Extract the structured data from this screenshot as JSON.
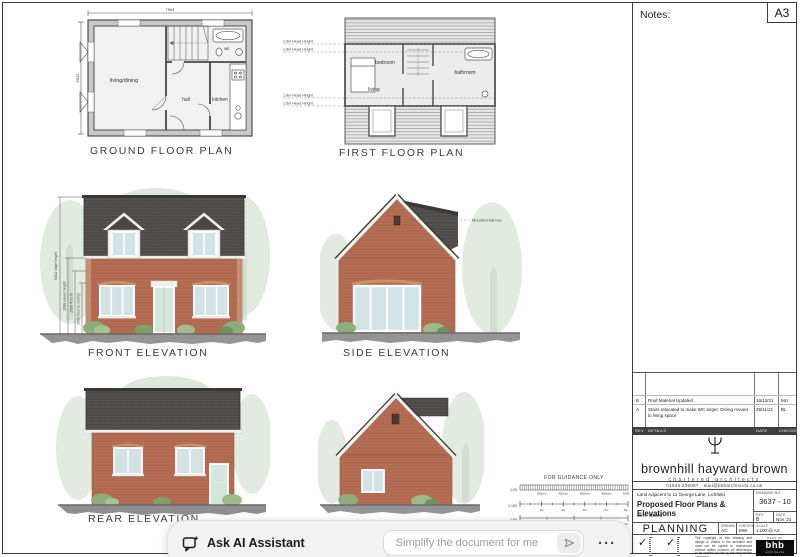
{
  "sheet": {
    "notes_label": "Notes:",
    "size_label": "A3"
  },
  "plans": {
    "ground": {
      "title": "GROUND FLOOR PLAN",
      "dim_width": "7904",
      "dim_height": "5532",
      "rooms": {
        "living": "living/dining",
        "hall": "hall",
        "kitchen": "kitchen",
        "wc": "wc"
      }
    },
    "first": {
      "title": "FIRST FLOOR PLAN",
      "rooms": {
        "bedroom": "bedroom",
        "living": "living",
        "bathroom": "bathroom"
      },
      "head_heights": [
        "1.5m Head Height",
        "1.8m Head Height",
        "1.8m Head Height",
        "1.5m Head Height"
      ]
    }
  },
  "elevations": {
    "front": {
      "title": "FRONT ELEVATION",
      "dims": [
        "6381 ridge height",
        "3088 eaves height",
        "2500 ffl to ffl",
        "2050 floor to ceiling"
      ]
    },
    "side": {
      "title": "SIDE ELEVATION",
      "annotation": "Mounted bat box"
    },
    "rear": {
      "title": "REAR ELEVATION"
    }
  },
  "scale_bar": {
    "title": "FOR GUIDANCE ONLY",
    "rows": [
      {
        "scale": "1:20",
        "ticks": [
          "200mm",
          "400mm",
          "600mm",
          "800mm",
          "1000"
        ]
      },
      {
        "scale": "1:100",
        "ticks": [
          "1m",
          "2m",
          "3m",
          "4m",
          "5m"
        ]
      },
      {
        "scale": "1:50",
        "ticks": [
          "1m",
          "2m"
        ]
      }
    ]
  },
  "revisions": {
    "header": {
      "rev": "REV",
      "details": "DETAILS",
      "date": "DATE",
      "checked": "CHECKED"
    },
    "rows": [
      {
        "rev": "B",
        "details": "Roof Material Updated",
        "date": "16/12/21",
        "by": "MU"
      },
      {
        "rev": "A",
        "details": "Stairs relocated to make WC larger. Dining moved to living space",
        "date": "29/11/21",
        "by": "BL"
      }
    ]
  },
  "firm": {
    "name": "brownhill hayward brown",
    "tagline": "chartered architects",
    "contact": "01543 236097  ·  mail@bhbarchitects.co.uk"
  },
  "title_block": {
    "project": "Land Adjacent to 11 George Lane, Lichfield",
    "drawing_title": "Proposed Floor Plans & Elevations",
    "client": "Mr A. Sansra",
    "status": "PLANNING",
    "drawn_label": "DRAWN",
    "drawn": "AC",
    "checked_label": "CHECKED",
    "checked": "MW",
    "drawing_no_label": "DRAWING NO.",
    "drawing_no": "3637 - 10",
    "rev_label": "REV",
    "rev": "B",
    "date_label": "DATE",
    "date": "Nov '21",
    "scale_label": "SCALE",
    "scale": "1:100 @ A3",
    "part_of": "PART OF",
    "logo_text": "bhb",
    "logo_sub": "architects",
    "copyright": "The copyright of this drawing and design is vested in the architect and must not be copied or reproduced without written consent. All dimensions to be verified on site by the responsible contractor."
  },
  "ai_bar": {
    "label": "Ask AI Assistant",
    "placeholder": "Simplify the document for me",
    "menu": "···"
  }
}
